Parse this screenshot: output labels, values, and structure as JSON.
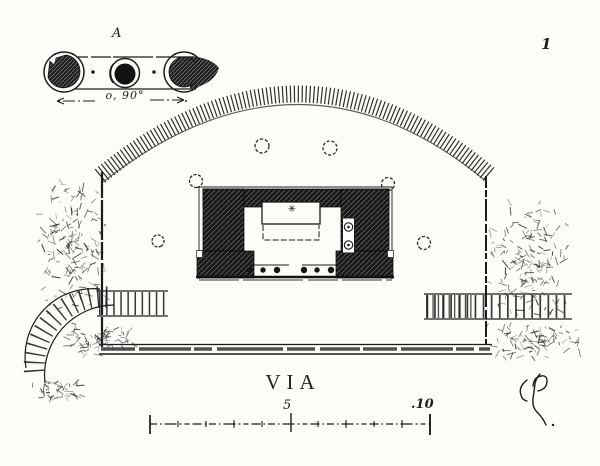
{
  "colors": {
    "paper": "#fcfcf9",
    "ink": "#1c1c1c"
  },
  "plate": {
    "number": "1"
  },
  "detail": {
    "label": "A",
    "dimension": "o, 90°"
  },
  "road": {
    "label": "VIA"
  },
  "monument": {
    "altar_mark": "✳"
  },
  "scale_bar": {
    "mid_label": "5",
    "end_label": ".10"
  }
}
